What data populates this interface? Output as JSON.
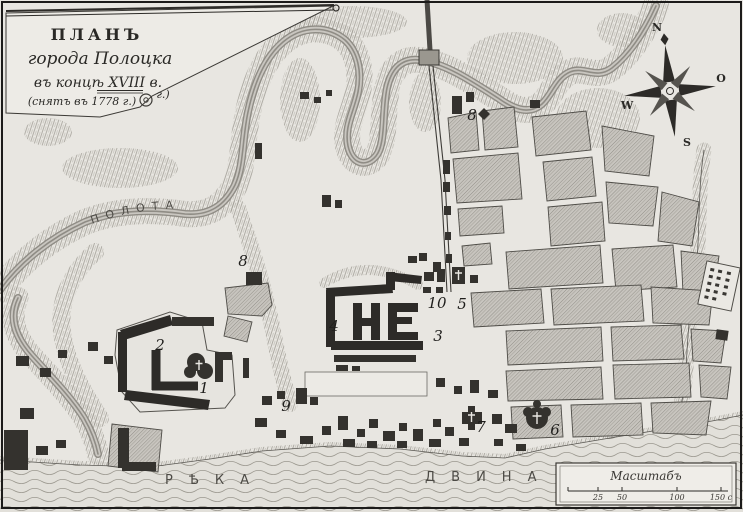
{
  "cartouche": {
    "line1": "ПЛАНЪ",
    "line2": "города Полоцка",
    "line3": "въ концѣ XVIII в.",
    "line3_suffix": "г.)",
    "line4": "(снятъ въ 1778 г.)"
  },
  "labels": {
    "polota": "ПОЛОТА",
    "dvina_word1": "РѢКА",
    "dvina_word2": "ДВИНА"
  },
  "compass": {
    "points": [
      {
        "label": "N",
        "x": 657,
        "y": 31
      },
      {
        "label": "O",
        "x": 721,
        "y": 82
      },
      {
        "label": "S",
        "x": 687,
        "y": 146
      },
      {
        "label": "W",
        "x": 627,
        "y": 109
      }
    ]
  },
  "scalebar": {
    "title": "Масштабъ",
    "ticks": [
      {
        "label": "",
        "x": 568
      },
      {
        "label": "25",
        "x": 598
      },
      {
        "label": "50",
        "x": 622
      },
      {
        "label": "100",
        "x": 677
      },
      {
        "label": "150 с",
        "x": 721
      }
    ]
  },
  "markers": [
    {
      "label": "1",
      "x": 204,
      "y": 393
    },
    {
      "label": "2",
      "x": 160,
      "y": 350
    },
    {
      "label": "3",
      "x": 438,
      "y": 341
    },
    {
      "label": "4",
      "x": 334,
      "y": 331
    },
    {
      "label": "5",
      "x": 462,
      "y": 309
    },
    {
      "label": "6",
      "x": 555,
      "y": 435
    },
    {
      "label": "7",
      "x": 481,
      "y": 432
    },
    {
      "label": "8",
      "x": 472,
      "y": 120
    },
    {
      "label": "8",
      "x": 243,
      "y": 266
    },
    {
      "label": "9",
      "x": 286,
      "y": 411
    },
    {
      "label": "10",
      "x": 437,
      "y": 308
    }
  ]
}
